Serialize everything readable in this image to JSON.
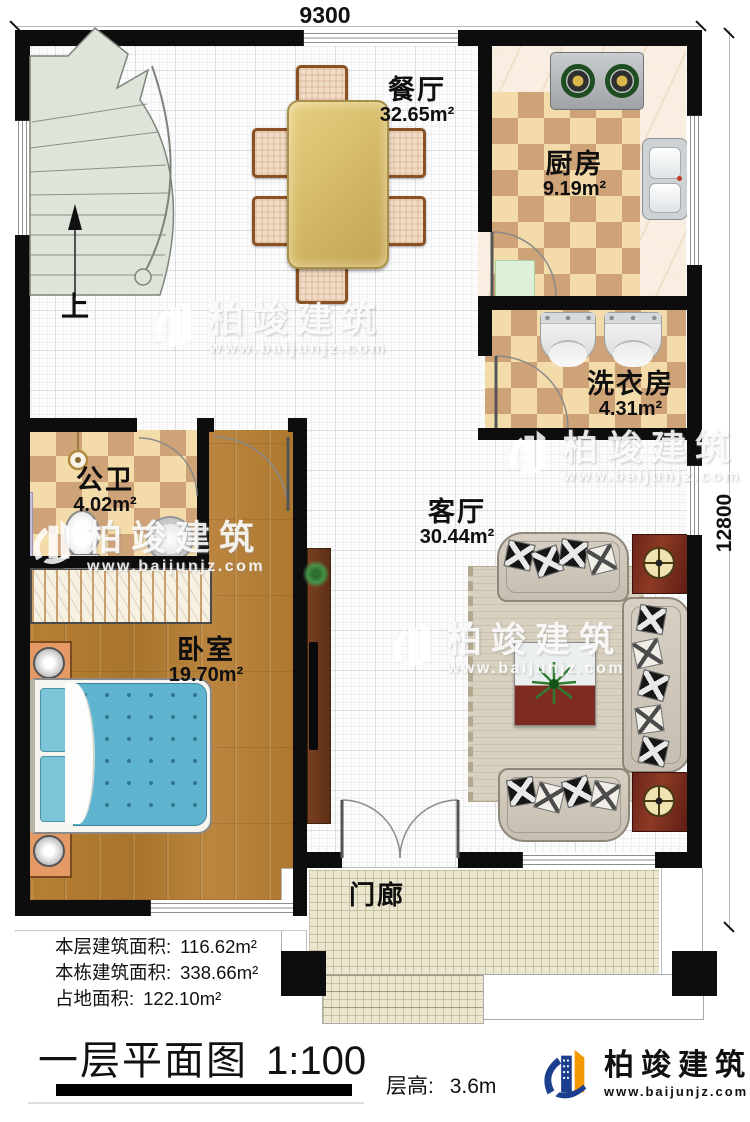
{
  "dimensions": {
    "width_label": "9300",
    "height_label": "12800"
  },
  "rooms": {
    "dining": {
      "name": "餐厅",
      "area": "32.65m²"
    },
    "kitchen": {
      "name": "厨房",
      "area": "9.19m²"
    },
    "laundry": {
      "name": "洗衣房",
      "area": "4.31m²"
    },
    "bathroom": {
      "name": "公卫",
      "area": "4.02m²"
    },
    "bedroom": {
      "name": "卧室",
      "area": "19.70m²"
    },
    "living": {
      "name": "客厅",
      "area": "30.44m²"
    },
    "porch": {
      "name": "门廊"
    }
  },
  "stairs": {
    "direction_label": "上"
  },
  "stats": {
    "floor_area_label": "本层建筑面积:",
    "floor_area_value": "116.62m²",
    "total_area_label": "本栋建筑面积:",
    "total_area_value": "338.66m²",
    "footprint_label": "占地面积:",
    "footprint_value": "122.10m²"
  },
  "title": {
    "name": "一层平面图",
    "scale": "1:100"
  },
  "floor_height": {
    "label": "层高:",
    "value": "3.6m"
  },
  "brand": {
    "name": "柏竣建筑",
    "website": "www.baijunjz.com"
  },
  "watermark": {
    "name": "柏竣建筑",
    "website": "www.baijunjz.com"
  },
  "colors": {
    "wall": "#0d0d0d",
    "tile_light": "#f3dcaa",
    "tile_dark": "#cfa378",
    "wood": "#b0792f",
    "bed": "#5fb4cf",
    "stairs": "#dee4da",
    "porch": "#eae6cf",
    "brand_blue": "#1c3e8e",
    "brand_orange": "#f39800"
  }
}
